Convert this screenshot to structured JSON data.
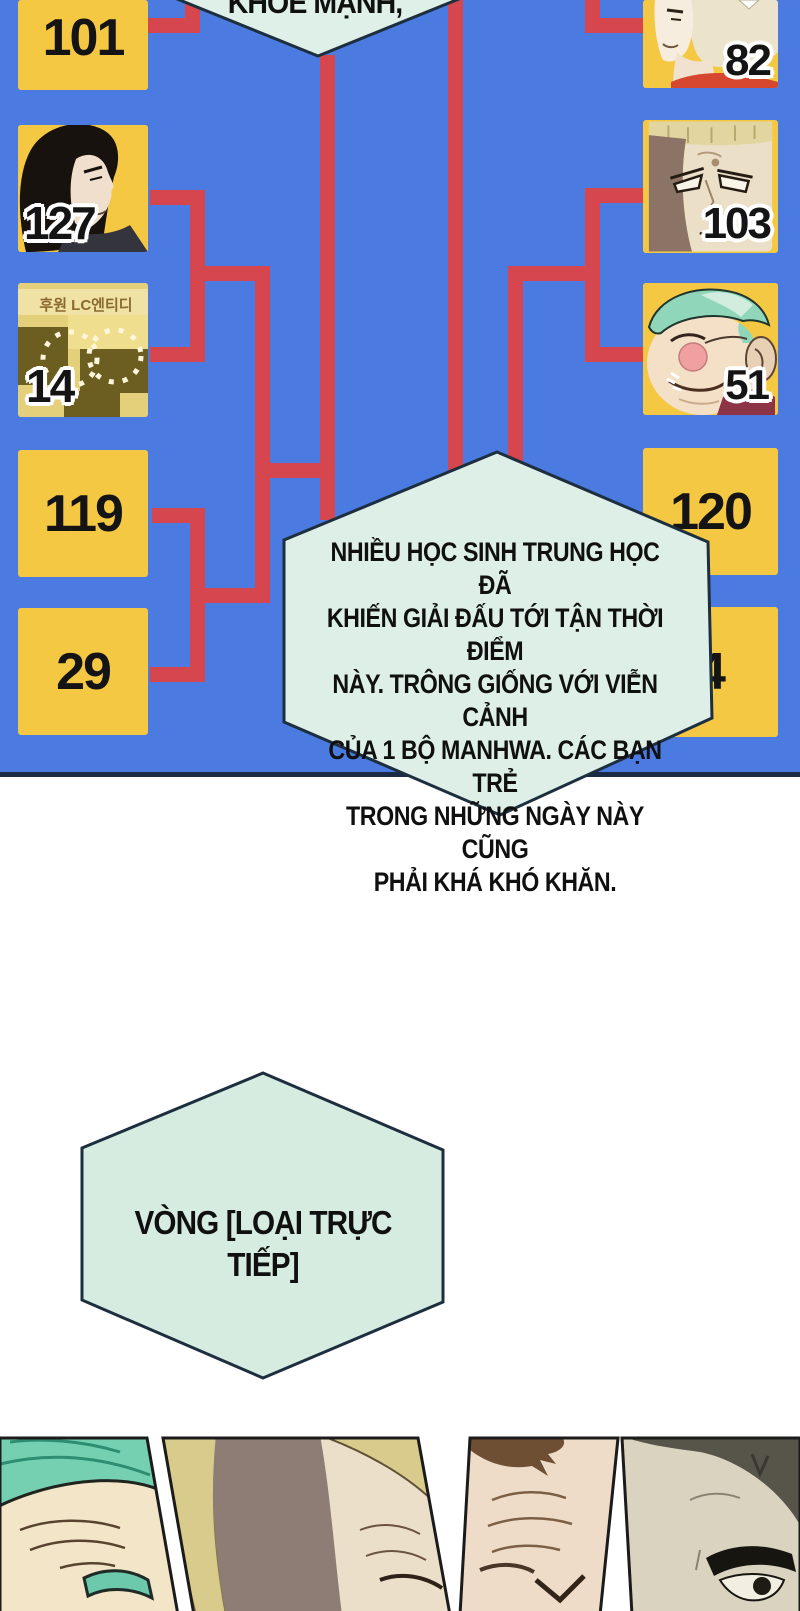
{
  "colors": {
    "panel_blue": "#4b7ae0",
    "bracket_red": "#d5464f",
    "seed_yellow": "#f5c843",
    "bubble_mint": "#ddefe7",
    "outline_navy": "#1d2f3e",
    "page_white": "#ffffff"
  },
  "top_bubble": {
    "text": "KHỎE MẠNH,"
  },
  "bracket": {
    "left_seeds": {
      "s101": "101",
      "s127": "127",
      "s14": "14",
      "s119": "119",
      "s29": "29"
    },
    "right_seeds": {
      "s82": "82",
      "s103": "103",
      "s51": "51",
      "s120": "120",
      "s4": "4"
    }
  },
  "censored_panel": {
    "caption": "후원 LC엔티디"
  },
  "center_bubble": {
    "lines": [
      "NHIỀU HỌC SINH TRUNG HỌC ĐÃ",
      "KHIẾN GIẢI ĐẤU TỚI TẬN THỜI ĐIỂM",
      "NÀY. TRÔNG GIỐNG VỚI VIỄN CẢNH",
      "CỦA 1 BỘ MANHWA. CÁC BẠN TRẺ",
      "TRONG NHỮNG NGÀY NÀY CŨNG",
      "PHẢI KHÁ KHÓ KHĂN."
    ]
  },
  "round_bubble": {
    "lines": [
      "VÒNG [LOẠI TRỰC",
      "TIẾP]"
    ]
  }
}
